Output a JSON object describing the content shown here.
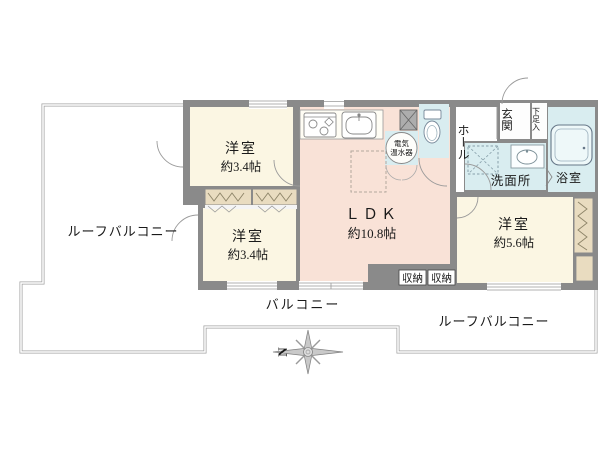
{
  "plan_title": "apartment-floor-plan",
  "rooms": {
    "bedroom_top": {
      "name": "洋室",
      "size": "約3.4帖"
    },
    "bedroom_bottom": {
      "name": "洋室",
      "size": "約3.4帖"
    },
    "bedroom_right": {
      "name": "洋室",
      "size": "約5.6帖"
    },
    "ldk": {
      "name": "ＬＤＫ",
      "size": "約10.8帖"
    },
    "hall": {
      "name": "ホール"
    },
    "entrance": {
      "name": "玄関"
    },
    "shoe_cabinet": {
      "name": "下足入"
    },
    "washroom": {
      "name": "洗面所"
    },
    "bathroom": {
      "name": "浴室"
    },
    "water_heater": {
      "line1": "電気",
      "line2": "温水器"
    },
    "storage_left": {
      "name": "収納"
    },
    "storage_right": {
      "name": "収納"
    },
    "balcony": {
      "name": "バルコニー"
    },
    "roof_balcony_left": {
      "name": "ルーフバルコニー"
    },
    "roof_balcony_right": {
      "name": "ルーフバルコニー"
    }
  },
  "compass": {
    "north": "N"
  },
  "colors": {
    "wall": "#8a8a8a",
    "bedroom_floor": "#fbf6e3",
    "ldk_floor": "#f9e2d7",
    "wet_area_floor": "#d9edf0",
    "closet": "#e9dcc0",
    "railing": "#a0a0a0"
  }
}
